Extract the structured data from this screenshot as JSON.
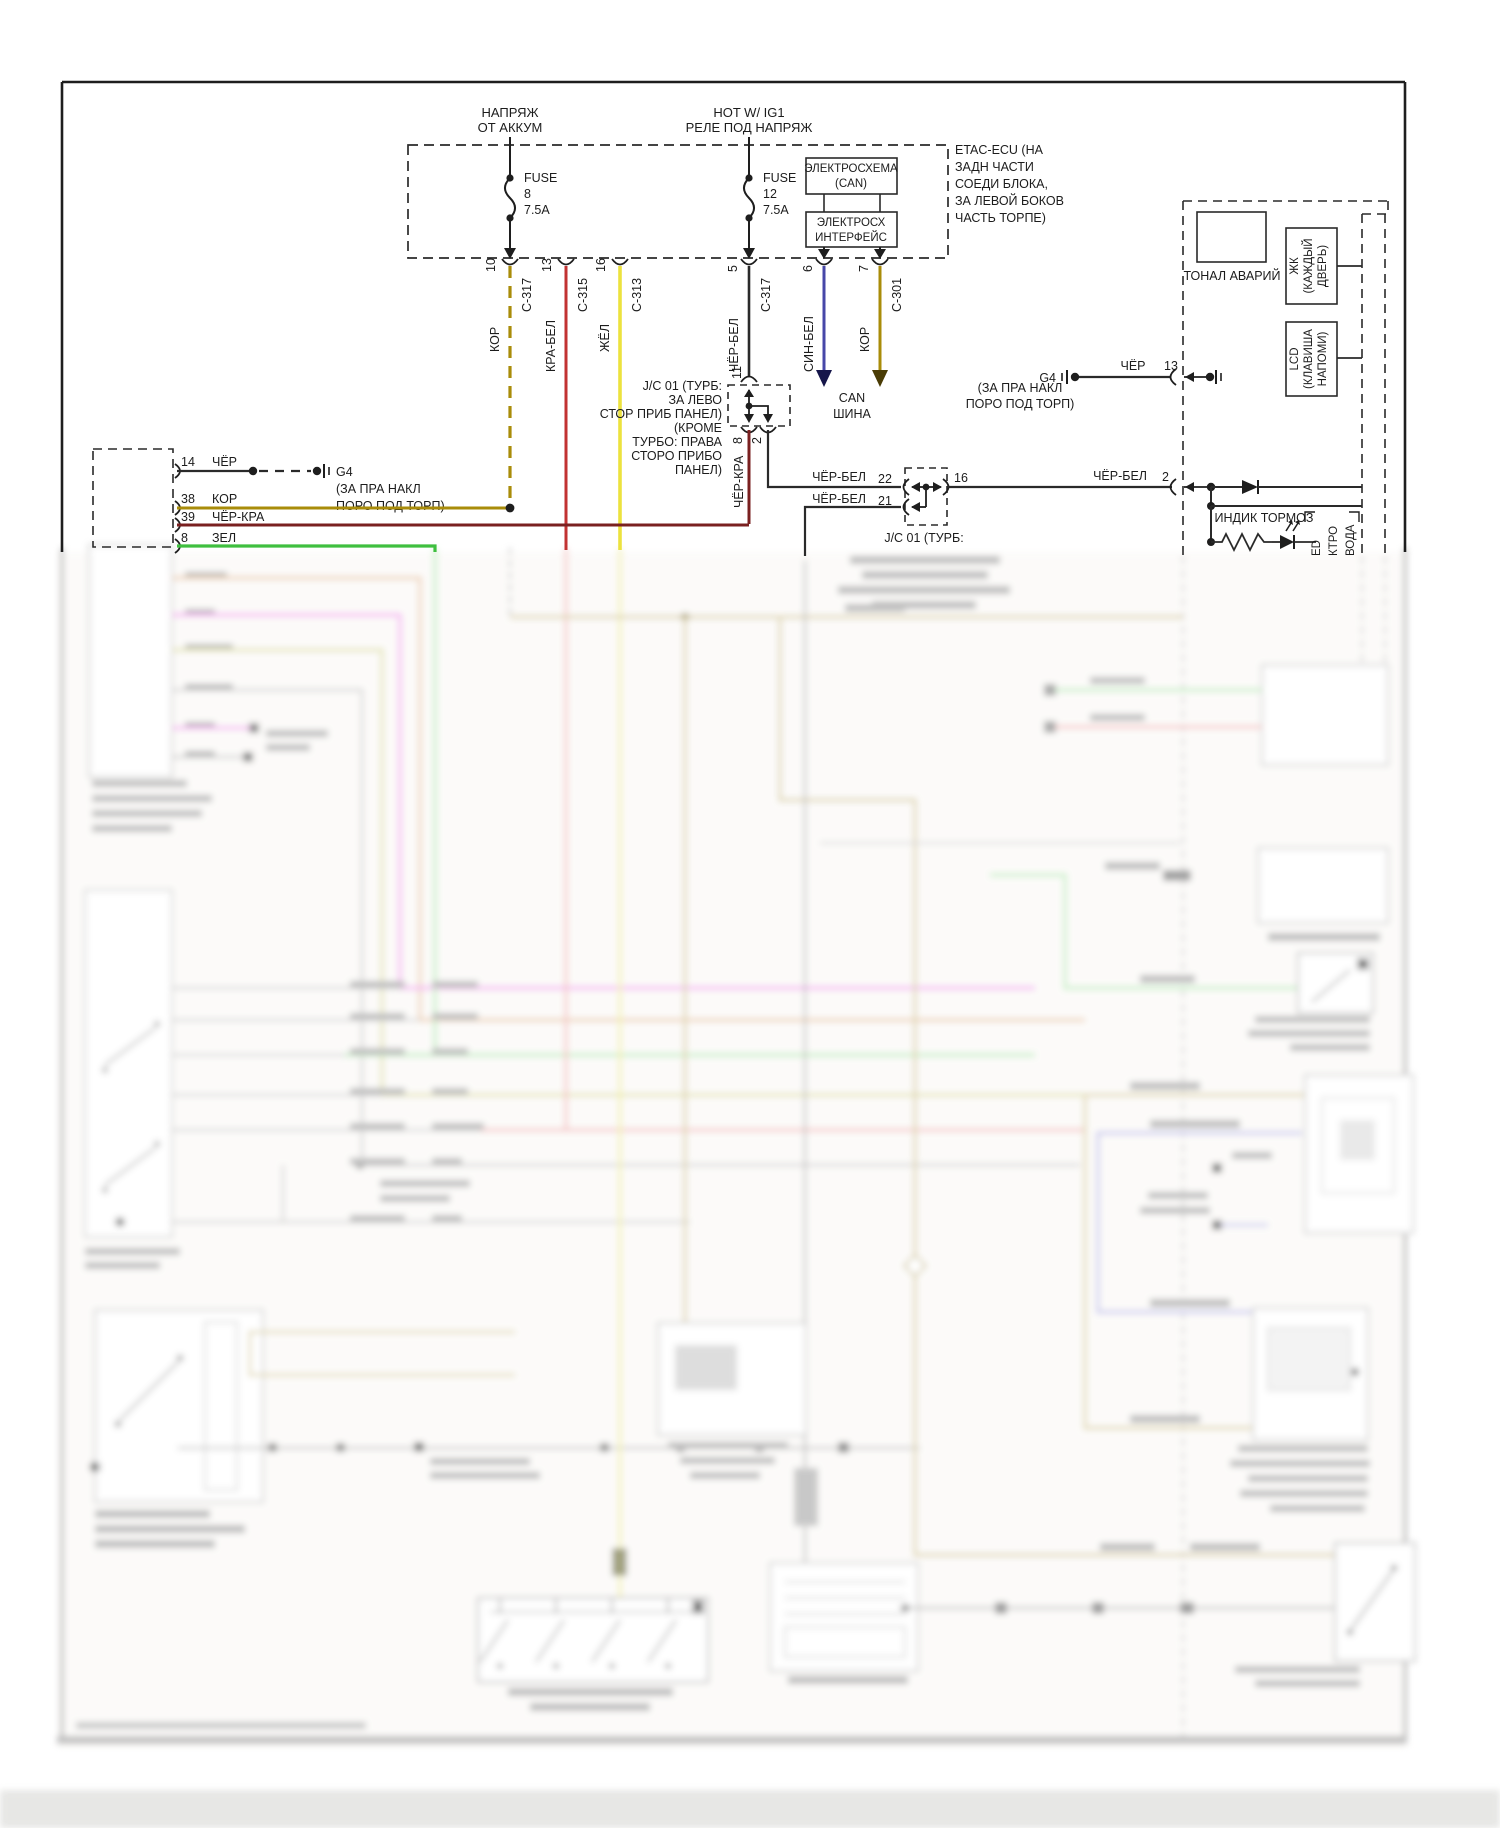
{
  "power": {
    "battery": [
      "НАПРЯЖ",
      "ОТ АККУМ"
    ],
    "ignition": [
      "HOT W/ IG1",
      "РЕЛЕ ПОД НАПРЯЖ"
    ],
    "fuse1": {
      "label": "FUSE",
      "number": "8",
      "rating": "7.5A"
    },
    "fuse2": {
      "label": "FUSE",
      "number": "12",
      "rating": "7.5A"
    }
  },
  "etac": {
    "location": [
      "ETAC-ECU (НА",
      "ЗАДН ЧАСТИ",
      "СОЕДИ БЛОКА,",
      "ЗА ЛЕВОЙ БОКОВ",
      "ЧАСТЬ ТОРПЕ)"
    ],
    "can_box": [
      "ЭЛЕКТРОСХЕМА",
      "(CAN)"
    ],
    "interface_box": [
      "ЭЛЕКТРОСХ",
      "ИНТЕРФЕЙС"
    ]
  },
  "top_pins": [
    {
      "pin": "10",
      "connector": "C-317",
      "wire": "КОР"
    },
    {
      "pin": "13",
      "connector": "C-315",
      "wire": "КРА-БЕЛ"
    },
    {
      "pin": "16",
      "connector": "C-313",
      "wire": "ЖЁЛ"
    },
    {
      "pin": "5",
      "connector": "C-317",
      "wire": "ЧЁР-БЕЛ"
    },
    {
      "pin": "6",
      "connector": "",
      "wire": "СИН-БЕЛ"
    },
    {
      "pin": "7",
      "connector": "C-301",
      "wire": "КОР"
    }
  ],
  "can_bus": [
    "CAN",
    "ШИНА"
  ],
  "jc1": {
    "location": [
      "J/C 01 (ТУРБ:",
      "ЗА ЛЕВО",
      "СТОР ПРИБ ПАНЕЛ)",
      "(КРОМЕ",
      "ТУРБО: ПРАВА",
      "СТОРО ПРИБО",
      "ПАНЕЛ)"
    ],
    "pin_in": "11",
    "pin_out_left": "8",
    "pin_out_right": "2",
    "wire_out_left": "ЧЁР-КРА"
  },
  "jc2": {
    "in1_wire": "ЧЁР-БЕЛ",
    "in1_pin": "22",
    "in2_wire": "ЧЁР-БЕЛ",
    "in2_pin": "21",
    "out_pin": "16",
    "label": "J/C 01 (ТУРБ:"
  },
  "left_connector": {
    "pins": [
      {
        "pin": "14",
        "wire": "ЧЁР"
      },
      {
        "pin": "38",
        "wire": "КОР"
      },
      {
        "pin": "39",
        "wire": "ЧЁР-КРА"
      },
      {
        "pin": "8",
        "wire": "ЗЕЛ"
      }
    ]
  },
  "ground_left": {
    "name": "G4",
    "location": [
      "(ЗА ПРА НАКЛ",
      "ПОРО ПОД ТОРП)"
    ]
  },
  "ground_right": {
    "name": "G4",
    "wire": "ЧЁР",
    "pin": "13",
    "location": [
      "(ЗА ПРА НАКЛ",
      "ПОРО ПОД ТОРП)"
    ]
  },
  "output_right": {
    "wire": "ЧЁР-БЕЛ",
    "pin": "2"
  },
  "brake_indicator": {
    "label": "ИНДИК ТОРМОЗ",
    "side_labels": [
      "ED",
      "КТРО",
      "ВОДА"
    ]
  },
  "hazard": {
    "label": "ТОНАЛ АВАРИЙ"
  },
  "lcd_door": [
    "ЖК",
    "(КАЖДЫЙ",
    "ДВЕРЬ)"
  ],
  "lcd_key": [
    "LCD",
    "(КЛАВИША",
    "НАПОМИ)"
  ],
  "colors": {
    "gold": "#a98c0a",
    "red": "#c23232",
    "yellow": "#ece23e",
    "blue": "#4747a8",
    "darkred": "#7a2020",
    "green": "#3fbf3f",
    "line": "#2a2a2a"
  }
}
